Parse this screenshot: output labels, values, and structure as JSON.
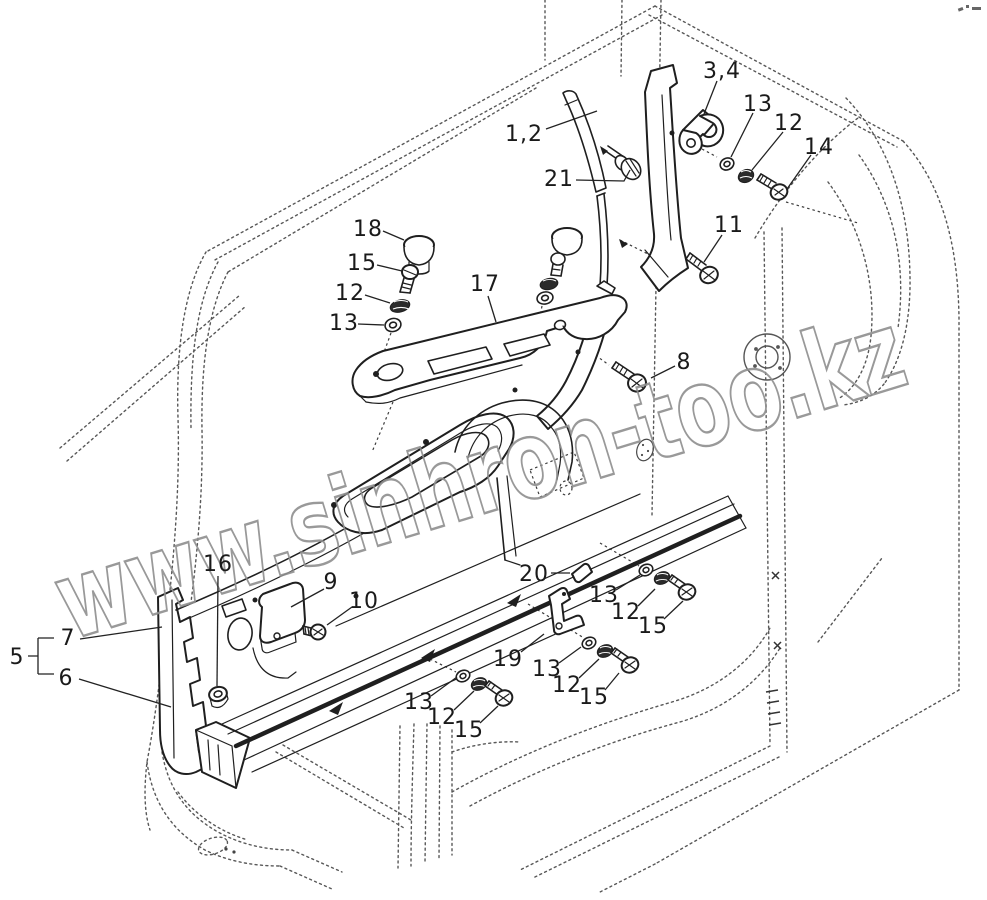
{
  "watermark": {
    "text": "www.sinhron-too.kz",
    "color": "#8f8f8f"
  },
  "diagram": {
    "ink": "#1a1a1a",
    "dotted_color": "#585858",
    "labels": [
      {
        "text": "1,2",
        "x": 524,
        "y": 133,
        "leader": [
          546,
          129,
          597,
          111
        ]
      },
      {
        "text": "3,4",
        "x": 722,
        "y": 70,
        "leader": [
          717,
          81,
          704,
          114
        ]
      },
      {
        "text": "13",
        "x": 758,
        "y": 103,
        "leader": [
          753,
          113,
          731,
          157
        ]
      },
      {
        "text": "12",
        "x": 789,
        "y": 122,
        "leader": [
          783,
          132,
          752,
          170
        ]
      },
      {
        "text": "14",
        "x": 819,
        "y": 146,
        "leader": [
          811,
          155,
          787,
          189
        ]
      },
      {
        "text": "21",
        "x": 559,
        "y": 178,
        "leader": [
          576,
          180,
          624,
          181,
          630,
          170
        ]
      },
      {
        "text": "11",
        "x": 729,
        "y": 224,
        "leader": [
          722,
          235,
          704,
          262
        ]
      },
      {
        "text": "18",
        "x": 368,
        "y": 228,
        "leader": [
          383,
          231,
          404,
          240
        ]
      },
      {
        "text": "15",
        "x": 362,
        "y": 262,
        "leader": [
          377,
          265,
          402,
          271
        ]
      },
      {
        "text": "12",
        "x": 350,
        "y": 292,
        "leader": [
          365,
          295,
          390,
          303
        ]
      },
      {
        "text": "13",
        "x": 344,
        "y": 322,
        "leader": [
          358,
          324,
          384,
          325
        ]
      },
      {
        "text": "17",
        "x": 485,
        "y": 283,
        "leader": [
          488,
          296,
          496,
          322
        ]
      },
      {
        "text": "8",
        "x": 684,
        "y": 361,
        "leader": [
          675,
          366,
          651,
          378
        ]
      },
      {
        "text": "16",
        "x": 218,
        "y": 563,
        "leader": [
          218,
          576,
          217,
          686
        ]
      },
      {
        "text": "9",
        "x": 331,
        "y": 581,
        "leader": [
          324,
          589,
          291,
          607
        ]
      },
      {
        "text": "10",
        "x": 364,
        "y": 600,
        "leader": [
          352,
          607,
          327,
          625
        ]
      },
      {
        "text": "5",
        "x": 17,
        "y": 656,
        "leader": null
      },
      {
        "text": "7",
        "x": 68,
        "y": 637,
        "leader": [
          80,
          639,
          162,
          627
        ]
      },
      {
        "text": "6",
        "x": 66,
        "y": 677,
        "leader": [
          79,
          679,
          171,
          707
        ]
      },
      {
        "text": "20",
        "x": 534,
        "y": 573,
        "leader": [
          551,
          573,
          570,
          573
        ]
      },
      {
        "text": "13",
        "x": 604,
        "y": 594,
        "leader": [
          616,
          590,
          640,
          575
        ]
      },
      {
        "text": "12",
        "x": 626,
        "y": 611,
        "leader": [
          638,
          606,
          655,
          589
        ]
      },
      {
        "text": "15",
        "x": 653,
        "y": 625,
        "leader": [
          664,
          619,
          683,
          601
        ]
      },
      {
        "text": "19",
        "x": 508,
        "y": 658,
        "leader": [
          521,
          652,
          544,
          634
        ]
      },
      {
        "text": "13",
        "x": 547,
        "y": 668,
        "leader": [
          559,
          663,
          581,
          647
        ]
      },
      {
        "text": "12",
        "x": 567,
        "y": 684,
        "leader": [
          579,
          678,
          599,
          659
        ]
      },
      {
        "text": "15",
        "x": 594,
        "y": 696,
        "leader": [
          605,
          690,
          619,
          673
        ]
      },
      {
        "text": "13",
        "x": 419,
        "y": 701,
        "leader": [
          431,
          696,
          457,
          677
        ]
      },
      {
        "text": "12",
        "x": 442,
        "y": 716,
        "leader": [
          454,
          710,
          474,
          691
        ]
      },
      {
        "text": "15",
        "x": 469,
        "y": 729,
        "leader": [
          480,
          723,
          498,
          706
        ]
      }
    ]
  }
}
